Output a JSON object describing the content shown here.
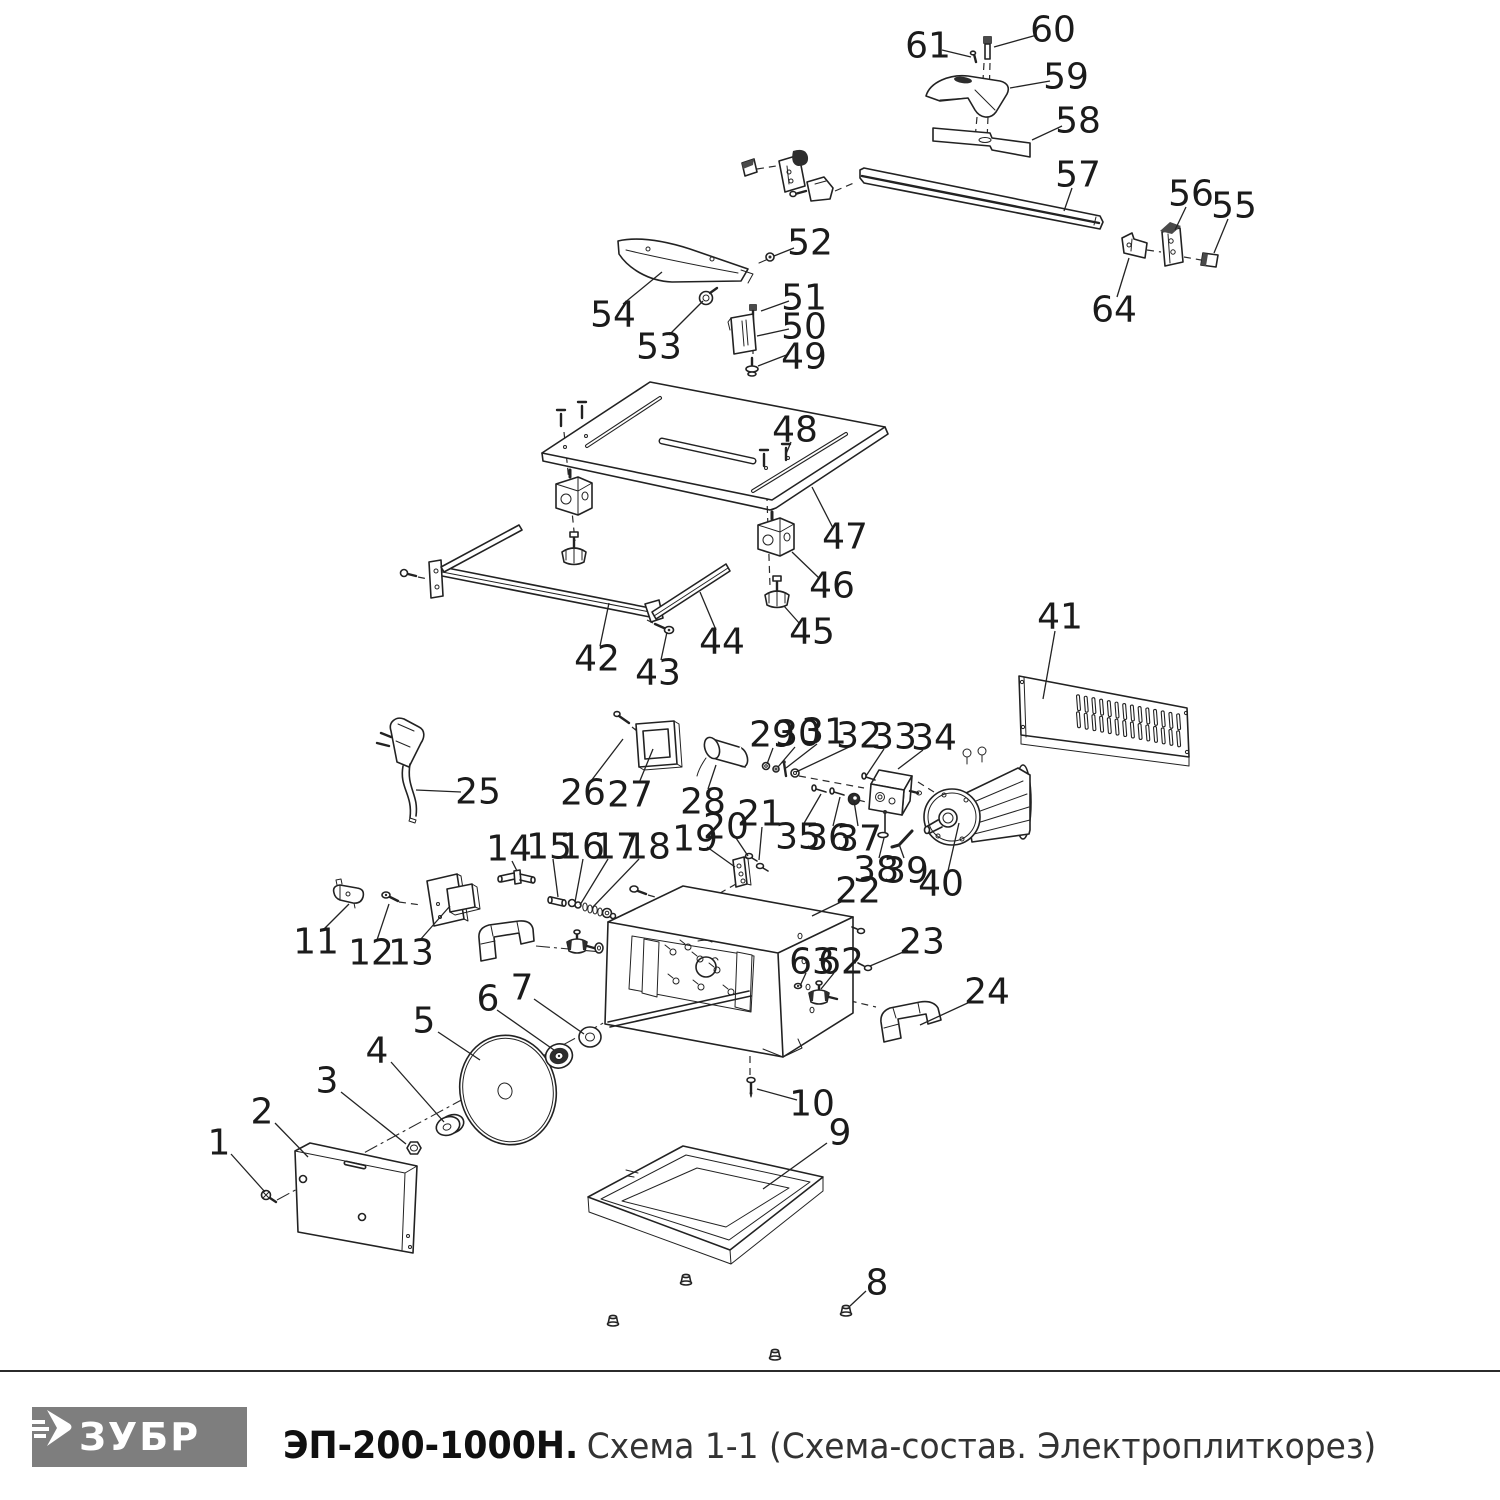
{
  "footer": {
    "brand": "ЗУБР",
    "model": "ЭП-200-1000Н.",
    "subtitle": "Схема 1-1 (Схема-состав. Электроплиткорез)",
    "logo_bg": "#7e7e7e"
  },
  "diagram": {
    "ink": "#222222",
    "labels": [
      {
        "n": "1",
        "tx": 219,
        "ty": 1143,
        "x1": 231,
        "y1": 1154,
        "x2": 265,
        "y2": 1192
      },
      {
        "n": "2",
        "tx": 262,
        "ty": 1112,
        "x1": 275,
        "y1": 1123,
        "x2": 308,
        "y2": 1157
      },
      {
        "n": "3",
        "tx": 327,
        "ty": 1081,
        "x1": 341,
        "y1": 1092,
        "x2": 406,
        "y2": 1144
      },
      {
        "n": "4",
        "tx": 377,
        "ty": 1051,
        "x1": 391,
        "y1": 1062,
        "x2": 444,
        "y2": 1122
      },
      {
        "n": "5",
        "tx": 424,
        "ty": 1021,
        "x1": 438,
        "y1": 1032,
        "x2": 480,
        "y2": 1060
      },
      {
        "n": "6",
        "tx": 488,
        "ty": 999,
        "x1": 497,
        "y1": 1010,
        "x2": 554,
        "y2": 1050
      },
      {
        "n": "7",
        "tx": 522,
        "ty": 988,
        "x1": 534,
        "y1": 999,
        "x2": 584,
        "y2": 1034
      },
      {
        "n": "8",
        "tx": 877,
        "ty": 1283,
        "x1": 866,
        "y1": 1291,
        "x2": 850,
        "y2": 1306
      },
      {
        "n": "9",
        "tx": 840,
        "ty": 1133,
        "x1": 827,
        "y1": 1143,
        "x2": 763,
        "y2": 1189
      },
      {
        "n": "10",
        "tx": 812,
        "ty": 1104,
        "x1": 797,
        "y1": 1100,
        "x2": 757,
        "y2": 1089
      },
      {
        "n": "11",
        "tx": 316,
        "ty": 942,
        "x1": 324,
        "y1": 929,
        "x2": 349,
        "y2": 904
      },
      {
        "n": "12",
        "tx": 371,
        "ty": 953,
        "x1": 377,
        "y1": 940,
        "x2": 389,
        "y2": 904
      },
      {
        "n": "13",
        "tx": 411,
        "ty": 953,
        "x1": 420,
        "y1": 940,
        "x2": 450,
        "y2": 906
      },
      {
        "n": "14",
        "tx": 509,
        "ty": 849,
        "x1": 512,
        "y1": 861,
        "x2": 517,
        "y2": 871
      },
      {
        "n": "15",
        "tx": 549,
        "ty": 847,
        "x1": 553,
        "y1": 859,
        "x2": 558,
        "y2": 897
      },
      {
        "n": "16",
        "tx": 582,
        "ty": 847,
        "x1": 583,
        "y1": 859,
        "x2": 575,
        "y2": 902
      },
      {
        "n": "17",
        "tx": 616,
        "ty": 847,
        "x1": 608,
        "y1": 859,
        "x2": 580,
        "y2": 905
      },
      {
        "n": "18",
        "tx": 648,
        "ty": 847,
        "x1": 639,
        "y1": 859,
        "x2": 592,
        "y2": 908
      },
      {
        "n": "19",
        "tx": 695,
        "ty": 839,
        "x1": 707,
        "y1": 847,
        "x2": 735,
        "y2": 867
      },
      {
        "n": "20",
        "tx": 726,
        "ty": 827,
        "x1": 736,
        "y1": 838,
        "x2": 748,
        "y2": 856
      },
      {
        "n": "21",
        "tx": 760,
        "ty": 814,
        "x1": 762,
        "y1": 827,
        "x2": 759,
        "y2": 860
      },
      {
        "n": "22",
        "tx": 858,
        "ty": 891,
        "x1": 845,
        "y1": 900,
        "x2": 812,
        "y2": 916
      },
      {
        "n": "23",
        "tx": 922,
        "ty": 942,
        "x1": 908,
        "y1": 950,
        "x2": 870,
        "y2": 966
      },
      {
        "n": "24",
        "tx": 987,
        "ty": 992,
        "x1": 972,
        "y1": 1001,
        "x2": 920,
        "y2": 1025
      },
      {
        "n": "25",
        "tx": 478,
        "ty": 792,
        "x1": 461,
        "y1": 792,
        "x2": 416,
        "y2": 790
      },
      {
        "n": "26",
        "tx": 583,
        "ty": 793,
        "x1": 591,
        "y1": 781,
        "x2": 623,
        "y2": 739
      },
      {
        "n": "27",
        "tx": 630,
        "ty": 795,
        "x1": 639,
        "y1": 783,
        "x2": 653,
        "y2": 749
      },
      {
        "n": "28",
        "tx": 703,
        "ty": 802,
        "x1": 708,
        "y1": 789,
        "x2": 716,
        "y2": 765
      },
      {
        "n": "29",
        "tx": 772,
        "ty": 735,
        "x1": 773,
        "y1": 748,
        "x2": 767,
        "y2": 764
      },
      {
        "n": "30",
        "tx": 798,
        "ty": 734,
        "x1": 795,
        "y1": 747,
        "x2": 778,
        "y2": 767
      },
      {
        "n": "31",
        "tx": 824,
        "ty": 732,
        "x1": 817,
        "y1": 744,
        "x2": 786,
        "y2": 768
      },
      {
        "n": "32",
        "tx": 859,
        "ty": 736,
        "x1": 849,
        "y1": 747,
        "x2": 796,
        "y2": 772
      },
      {
        "n": "33",
        "tx": 894,
        "ty": 737,
        "x1": 884,
        "y1": 749,
        "x2": 866,
        "y2": 776
      },
      {
        "n": "34",
        "tx": 934,
        "ty": 738,
        "x1": 923,
        "y1": 750,
        "x2": 898,
        "y2": 769
      },
      {
        "n": "35",
        "tx": 798,
        "ty": 837,
        "x1": 803,
        "y1": 825,
        "x2": 821,
        "y2": 794
      },
      {
        "n": "36",
        "tx": 828,
        "ty": 838,
        "x1": 833,
        "y1": 826,
        "x2": 840,
        "y2": 797
      },
      {
        "n": "37",
        "tx": 859,
        "ty": 839,
        "x1": 858,
        "y1": 826,
        "x2": 854,
        "y2": 801
      },
      {
        "n": "38",
        "tx": 876,
        "ty": 870,
        "x1": 879,
        "y1": 858,
        "x2": 884,
        "y2": 838
      },
      {
        "n": "39",
        "tx": 906,
        "ty": 871,
        "x1": 904,
        "y1": 858,
        "x2": 899,
        "y2": 844
      },
      {
        "n": "40",
        "tx": 941,
        "ty": 884,
        "x1": 948,
        "y1": 871,
        "x2": 959,
        "y2": 823
      },
      {
        "n": "41",
        "tx": 1060,
        "ty": 617,
        "x1": 1055,
        "y1": 631,
        "x2": 1043,
        "y2": 699
      },
      {
        "n": "42",
        "tx": 597,
        "ty": 659,
        "x1": 600,
        "y1": 646,
        "x2": 609,
        "y2": 603
      },
      {
        "n": "43",
        "tx": 658,
        "ty": 673,
        "x1": 661,
        "y1": 660,
        "x2": 667,
        "y2": 632
      },
      {
        "n": "44",
        "tx": 722,
        "ty": 642,
        "x1": 716,
        "y1": 630,
        "x2": 700,
        "y2": 592
      },
      {
        "n": "45",
        "tx": 812,
        "ty": 632,
        "x1": 800,
        "y1": 624,
        "x2": 784,
        "y2": 606
      },
      {
        "n": "46",
        "tx": 832,
        "ty": 586,
        "x1": 819,
        "y1": 578,
        "x2": 792,
        "y2": 552
      },
      {
        "n": "47",
        "tx": 845,
        "ty": 537,
        "x1": 833,
        "y1": 528,
        "x2": 812,
        "y2": 487
      },
      {
        "n": "48",
        "tx": 795,
        "ty": 430,
        "x1": 791,
        "y1": 442,
        "x2": 786,
        "y2": 454
      },
      {
        "n": "49",
        "tx": 804,
        "ty": 357,
        "x1": 789,
        "y1": 354,
        "x2": 758,
        "y2": 366
      },
      {
        "n": "50",
        "tx": 804,
        "ty": 327,
        "x1": 789,
        "y1": 329,
        "x2": 757,
        "y2": 336
      },
      {
        "n": "51",
        "tx": 804,
        "ty": 298,
        "x1": 789,
        "y1": 301,
        "x2": 761,
        "y2": 311
      },
      {
        "n": "52",
        "tx": 810,
        "ty": 243,
        "x1": 794,
        "y1": 248,
        "x2": 774,
        "y2": 256
      },
      {
        "n": "53",
        "tx": 659,
        "ty": 347,
        "x1": 669,
        "y1": 335,
        "x2": 703,
        "y2": 301
      },
      {
        "n": "54",
        "tx": 613,
        "ty": 315,
        "x1": 623,
        "y1": 304,
        "x2": 662,
        "y2": 272
      },
      {
        "n": "55",
        "tx": 1234,
        "ty": 206,
        "x1": 1228,
        "y1": 219,
        "x2": 1214,
        "y2": 253
      },
      {
        "n": "56",
        "tx": 1191,
        "ty": 194,
        "x1": 1186,
        "y1": 207,
        "x2": 1175,
        "y2": 230
      },
      {
        "n": "57",
        "tx": 1078,
        "ty": 175,
        "x1": 1072,
        "y1": 188,
        "x2": 1064,
        "y2": 211
      },
      {
        "n": "58",
        "tx": 1078,
        "ty": 121,
        "x1": 1062,
        "y1": 126,
        "x2": 1032,
        "y2": 140
      },
      {
        "n": "59",
        "tx": 1066,
        "ty": 77,
        "x1": 1050,
        "y1": 81,
        "x2": 1010,
        "y2": 88
      },
      {
        "n": "60",
        "tx": 1053,
        "ty": 30,
        "x1": 1037,
        "y1": 35,
        "x2": 994,
        "y2": 47
      },
      {
        "n": "61",
        "tx": 928,
        "ty": 46,
        "x1": 942,
        "y1": 50,
        "x2": 971,
        "y2": 57
      },
      {
        "n": "62",
        "tx": 841,
        "ty": 962,
        "x1": 834,
        "y1": 973,
        "x2": 821,
        "y2": 989
      },
      {
        "n": "63",
        "tx": 812,
        "ty": 962,
        "x1": 806,
        "y1": 973,
        "x2": 800,
        "y2": 986
      },
      {
        "n": "64",
        "tx": 1114,
        "ty": 310,
        "x1": 1117,
        "y1": 297,
        "x2": 1129,
        "y2": 258
      }
    ]
  }
}
